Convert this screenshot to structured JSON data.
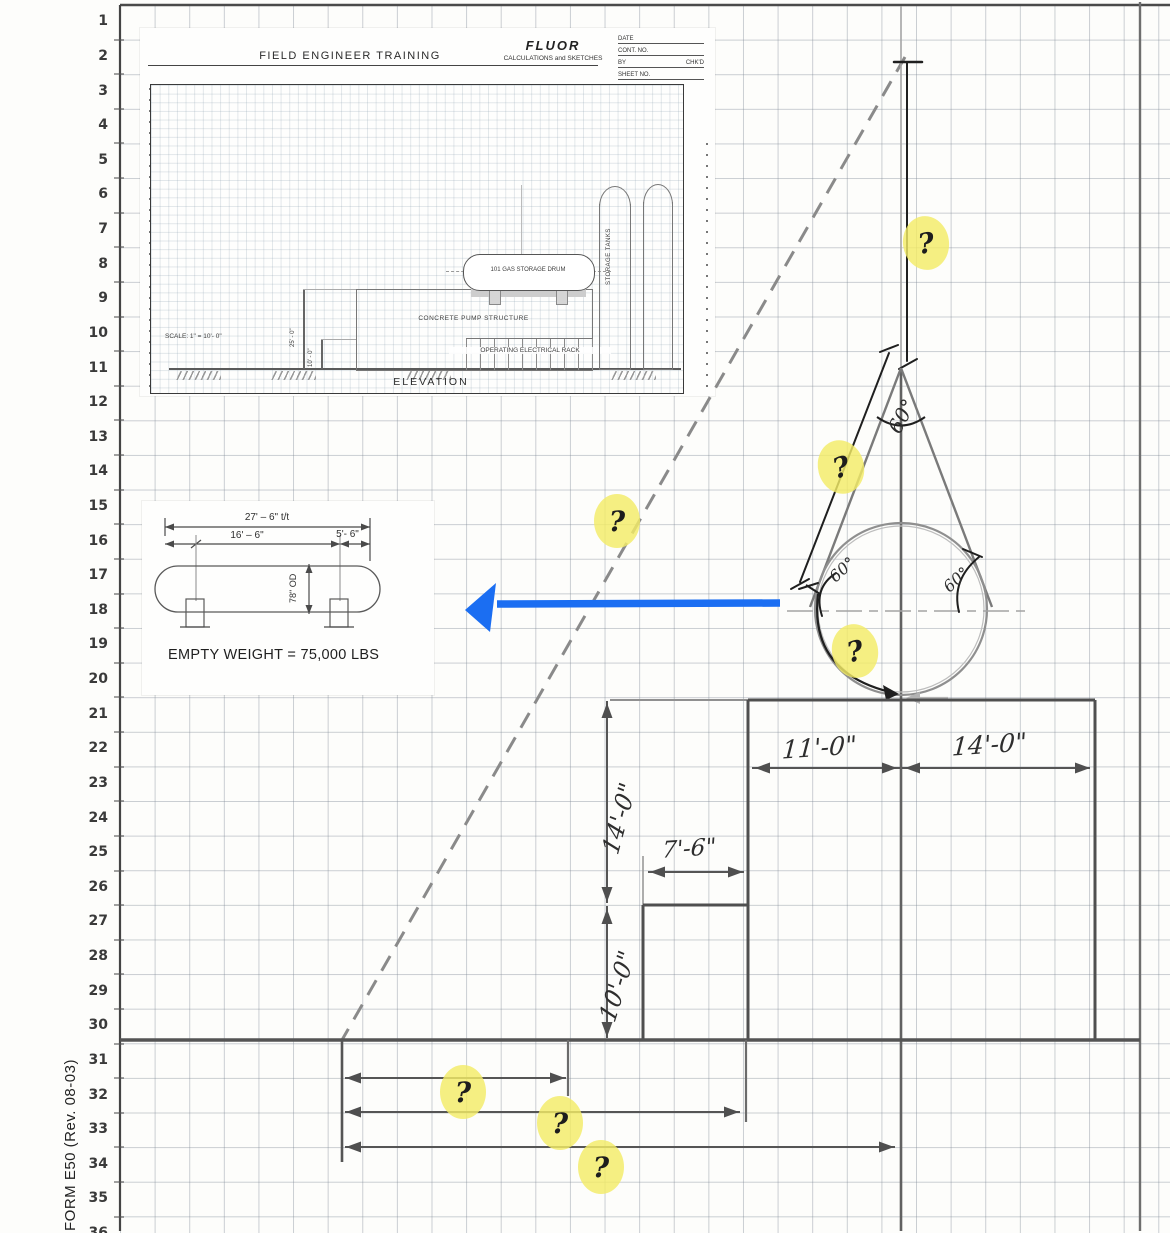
{
  "page": {
    "form_label": "FORM E50  (Rev. 08-03)"
  },
  "grid": {
    "rows": [
      "1",
      "2",
      "3",
      "4",
      "5",
      "6",
      "7",
      "8",
      "9",
      "10",
      "11",
      "12",
      "13",
      "14",
      "15",
      "16",
      "17",
      "18",
      "19",
      "20",
      "21",
      "22",
      "23",
      "24",
      "25",
      "26",
      "27",
      "28",
      "29",
      "30",
      "31",
      "32",
      "33",
      "34",
      "35",
      "36"
    ]
  },
  "training_sheet": {
    "title": "FIELD ENGINEER TRAINING",
    "brand": "FLUOR",
    "subtitle": "CALCULATIONS and SKETCHES",
    "field_date": "DATE",
    "field_cont": "CONT. NO.",
    "field_by": "BY",
    "field_chkd": "CHK'D",
    "field_sheet": "SHEET NO.",
    "drum_label": "101 GAS STORAGE DRUM",
    "structure_label": "CONCRETE PUMP STRUCTURE",
    "rack_label": "OPERATING ELECTRICAL RACK",
    "tanks_label": "STORAGE TANKS",
    "dim_25": "25' - 0\"",
    "dim_10": "10' - 0\"",
    "scale_note": "SCALE:  1\" = 10'- 0\"",
    "view_label": "ELEVATION"
  },
  "drum_detail": {
    "dim_tt": "27' – 6\" t/t",
    "dim_mid": "16' – 6\"",
    "dim_end": "5'- 6\"",
    "dim_od": "78\" OD",
    "weight": "EMPTY WEIGHT = 75,000 LBS"
  },
  "sketch": {
    "angles": [
      "60°",
      "60°",
      "60°"
    ],
    "dims": {
      "left_width": "11'-0\"",
      "right_width": "14'-0\"",
      "height_upper": "14'-0\"",
      "notch_width": "7'-6\"",
      "height_lower": "10'-0\""
    },
    "qmarks": [
      "?",
      "?",
      "?",
      "?",
      "?",
      "?",
      "?"
    ]
  },
  "colors": {
    "highlight": "#f3eb67",
    "blue_arrow": "#1b6ef2",
    "pencil": "#6e6e6e"
  }
}
